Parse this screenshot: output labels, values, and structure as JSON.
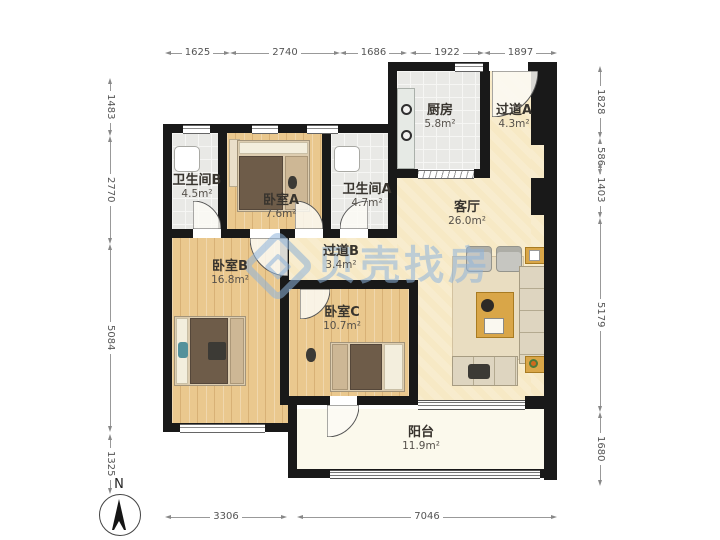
{
  "floorplan": {
    "rooms": {
      "bathroom_b": {
        "name": "卫生间B",
        "area": "4.5m²"
      },
      "bedroom_a": {
        "name": "卧室A",
        "area": "7.6m²"
      },
      "bathroom_a": {
        "name": "卫生间A",
        "area": "4.7m²"
      },
      "kitchen": {
        "name": "厨房",
        "area": "5.8m²"
      },
      "hallway_a": {
        "name": "过道A",
        "area": "4.3m²"
      },
      "living_room": {
        "name": "客厅",
        "area": "26.0m²"
      },
      "bedroom_b": {
        "name": "卧室B",
        "area": "16.8m²"
      },
      "hallway_b": {
        "name": "过道B",
        "area": "3.4m²"
      },
      "bedroom_c": {
        "name": "卧室C",
        "area": "10.7m²"
      },
      "balcony": {
        "name": "阳台",
        "area": "11.9m²"
      }
    },
    "dimensions": {
      "top": [
        "1625",
        "2740",
        "1686",
        "1922",
        "1897"
      ],
      "left": [
        "1483",
        "2770",
        "5084",
        "1325"
      ],
      "right": [
        "1828",
        "586",
        "1403",
        "5179",
        "1680"
      ],
      "bottom": [
        "3306",
        "7046"
      ]
    },
    "compass": {
      "label": "N"
    },
    "watermark": {
      "text": "贝壳找房"
    },
    "colors": {
      "wall": "#191919",
      "bedroom_floor": "#eac88e",
      "living_floor": "#f7e9c5",
      "tile_floor": "#e9e9e6",
      "balcony_floor": "#fbf9ec",
      "watermark_blue": "#8fb4dc"
    }
  }
}
